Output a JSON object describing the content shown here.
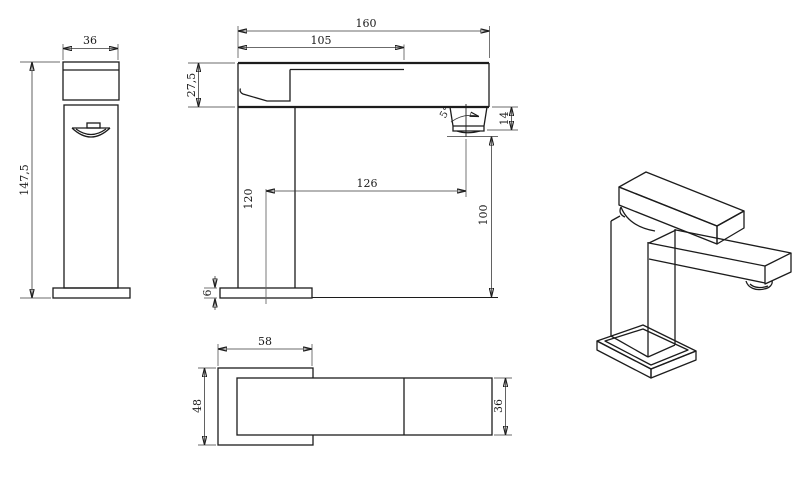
{
  "drawing": {
    "background_color": "#ffffff",
    "line_color": "#1c1c1c",
    "dimension_color": "#3a3a3a",
    "views": {
      "side": {
        "title": "side-view",
        "dims": {
          "handle_width": "36",
          "total_height": "147,5"
        }
      },
      "front": {
        "title": "front-view",
        "dims": {
          "overall_length": "160",
          "handle_length": "105",
          "spout_section_height": "27,5",
          "spray_angle": "5°",
          "outlet_depth": "14",
          "spout_reach": "126",
          "body_height": "120",
          "outlet_clearance": "100",
          "base_plate_thickness": "6"
        }
      },
      "plan": {
        "title": "plan-view",
        "dims": {
          "base_plate_length": "58",
          "base_plate_width": "48",
          "spout_width": "36"
        }
      },
      "isometric": {
        "title": "isometric-view"
      }
    }
  }
}
